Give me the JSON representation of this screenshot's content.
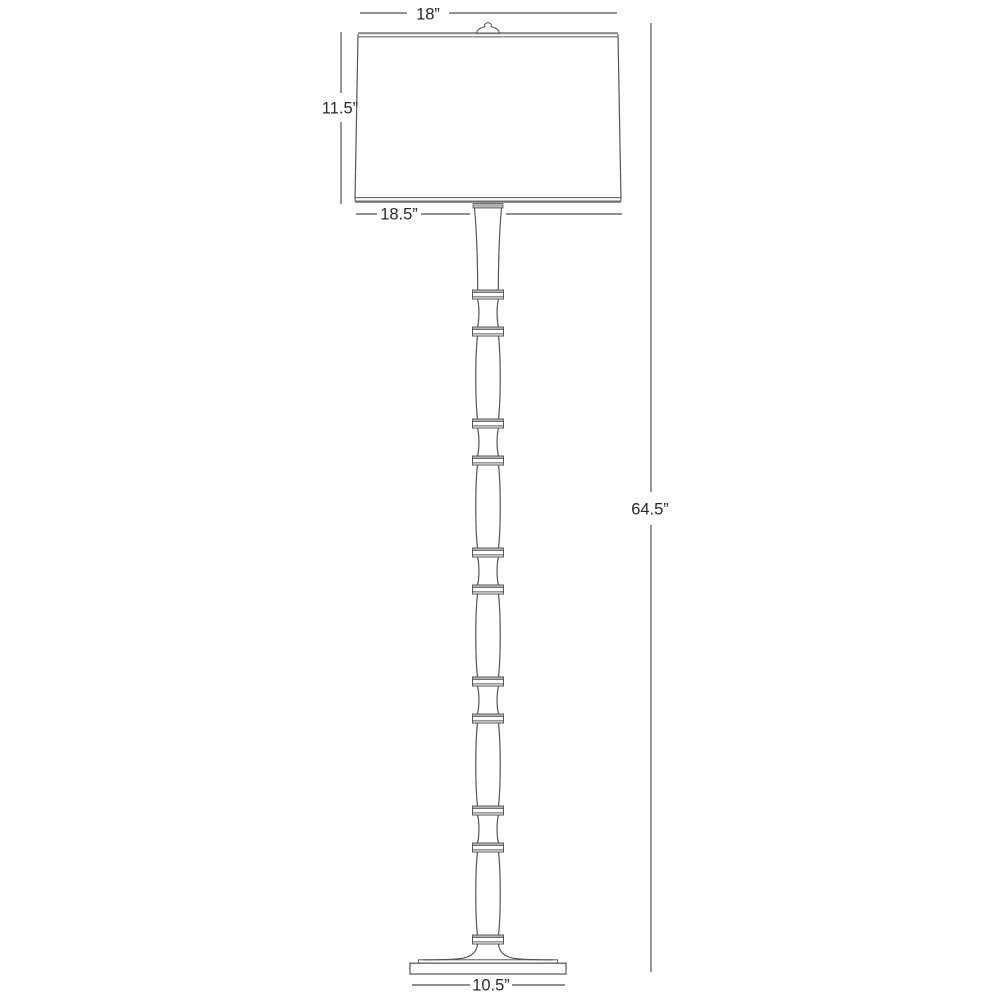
{
  "diagram": {
    "kind": "dimension-drawing",
    "subject": "bamboo-style floor lamp line drawing with dimension callouts",
    "labels": {
      "shade_top_width": "18”",
      "shade_height": "11.5”",
      "shade_bottom_width": "18.5”",
      "total_height": "64.5”",
      "base_width": "10.5”"
    },
    "colors": {
      "background": "#ffffff",
      "outline": "#55565a",
      "shade_line": "#8a8c8e",
      "node_fill": "#b0b2b4",
      "dimension_line": "#6a6b6d",
      "text": "#2a2a2c"
    }
  }
}
